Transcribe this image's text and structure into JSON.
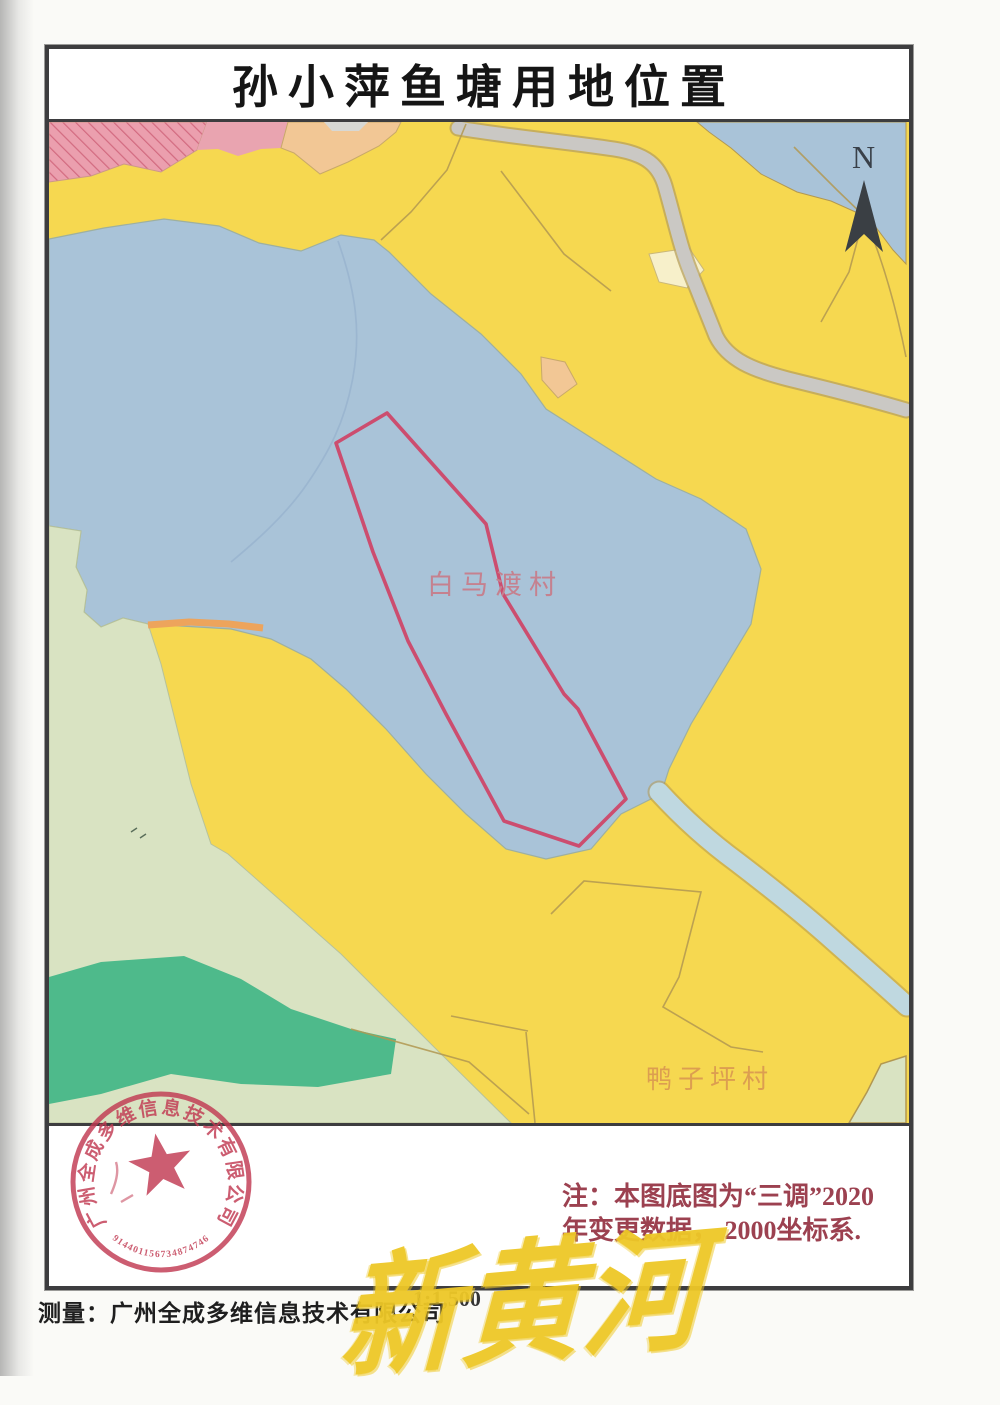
{
  "title": {
    "text": "孙小萍鱼塘用地位置"
  },
  "compass": {
    "label": "N"
  },
  "map_labels": {
    "village1": "白马渡村",
    "village2": "鸭子坪村"
  },
  "note": {
    "line1": "注：本图底图为“三调”2020",
    "line2": "年变更数据， 2000坐标系."
  },
  "bottom": {
    "surveyor": "测量：广州全成多维信息技术有限公司",
    "scale": "1:1,500"
  },
  "stamp": {
    "company": "广州全成多维信息技术有限公司",
    "serial": "914401156734874746"
  },
  "watermark": {
    "text": "新黄河"
  },
  "colors": {
    "base_yellow": "#f6d850",
    "lake_blue": "#a9c3d8",
    "river_blue": "#bfd8e0",
    "light_green": "#d9e3c2",
    "dark_green": "#4eba8b",
    "pink": "#eb9fae",
    "peach": "#f2c795",
    "road_gray": "#cac8c4",
    "boundary_tan": "#b29851",
    "plot_red": "#cc4d6f",
    "stamp_red": "#c13a52",
    "note_red": "#9c4150",
    "watermark_yellow": "#eec827"
  }
}
